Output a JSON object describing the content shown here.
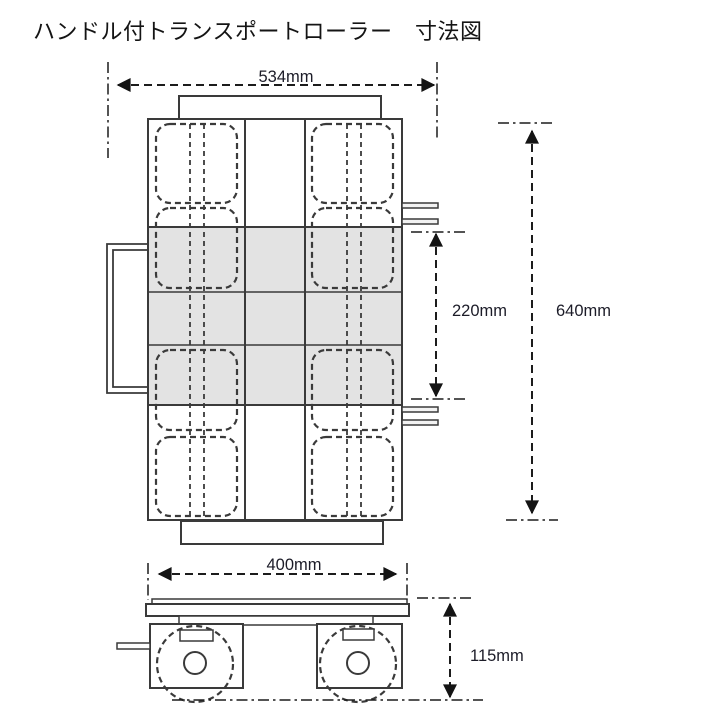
{
  "title": "ハンドル付トランスポートローラー　寸法図",
  "dimensions": {
    "overall_width": "534mm",
    "roller_pitch": "220mm",
    "overall_length": "640mm",
    "deck_width": "400mm",
    "overall_height": "115mm"
  },
  "colors": {
    "line": "#3a3a3a",
    "dimension_line": "#1c1c1c",
    "label_text": "#1c1c28",
    "platform_fill": "#e3e3e3",
    "background": "#ffffff"
  }
}
